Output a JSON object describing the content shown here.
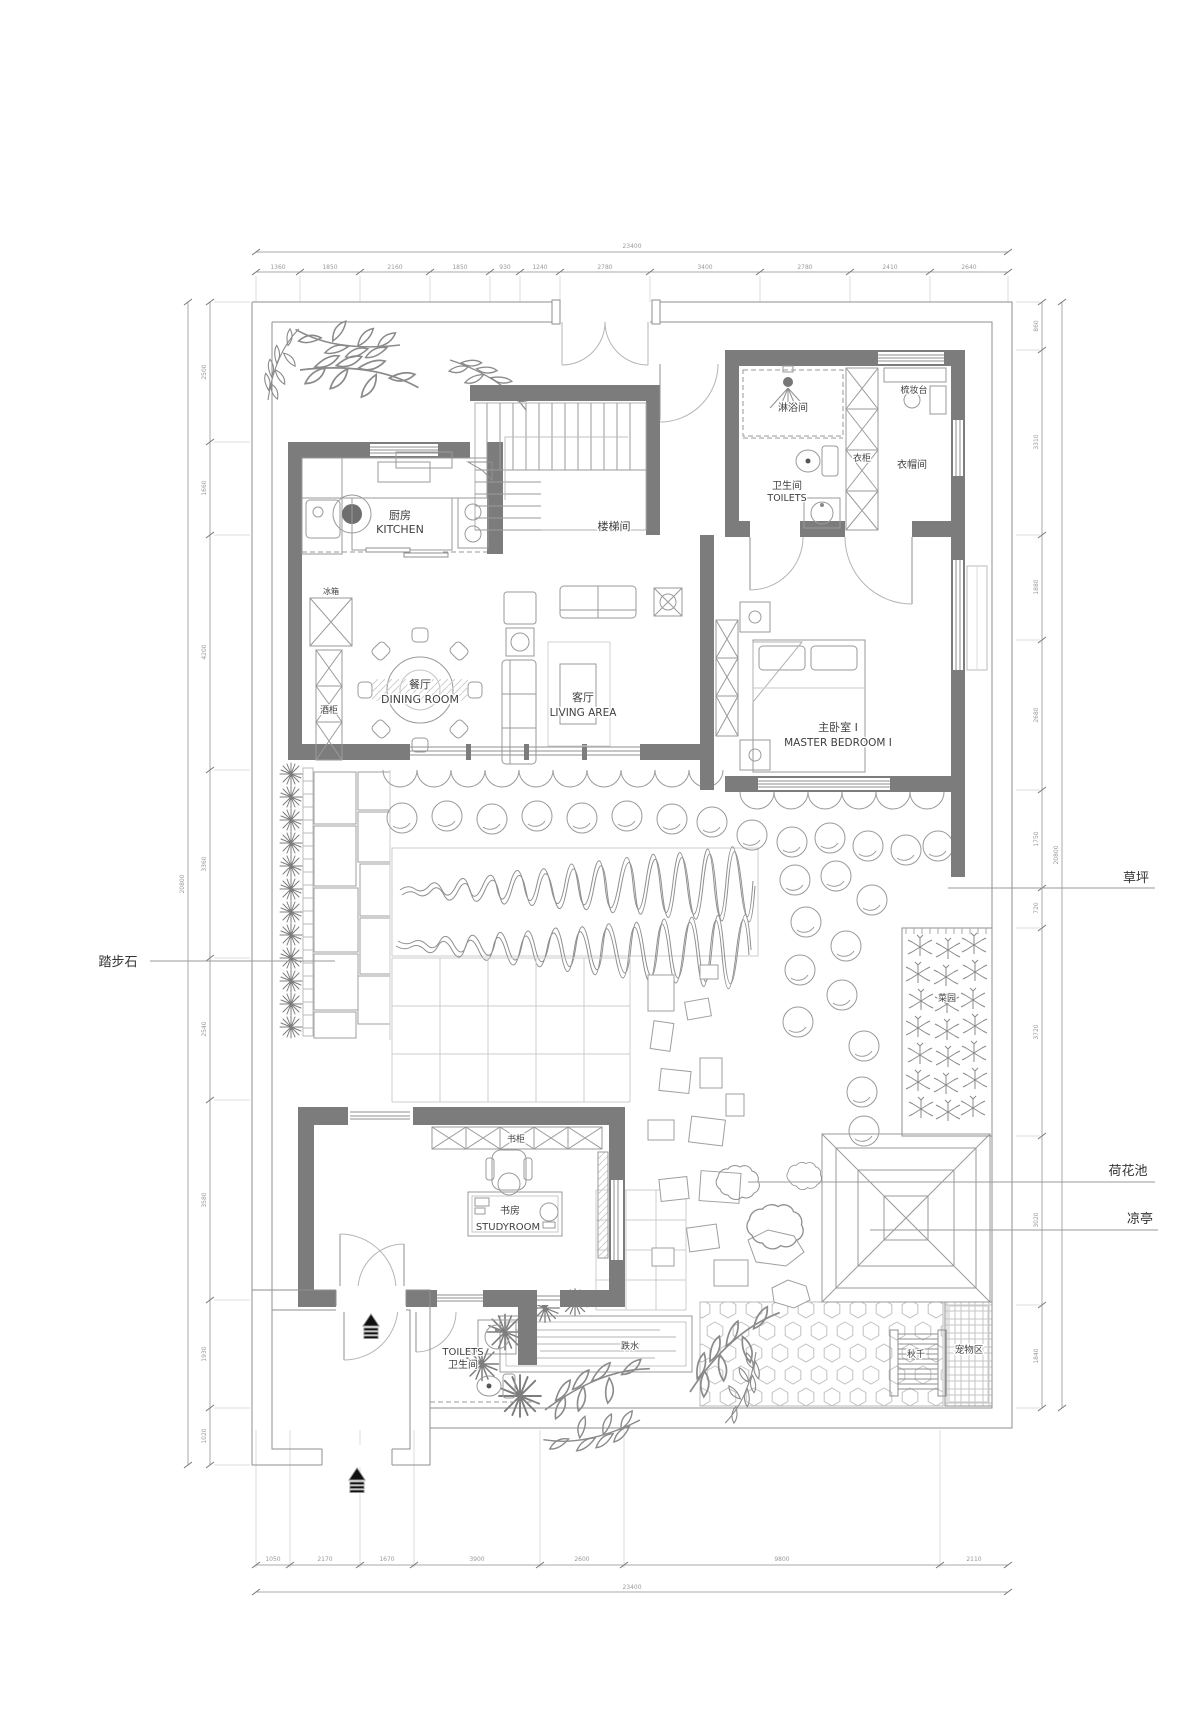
{
  "drawing": {
    "type": "residential floor plan with courtyard garden"
  },
  "rooms": {
    "kitchen": {
      "zh": "厨房",
      "en": "KITCHEN"
    },
    "stairwell": {
      "zh": "楼梯间"
    },
    "shower": {
      "zh": "淋浴间"
    },
    "toilet_upper": {
      "zh": "卫生间",
      "en": "TOILETS"
    },
    "wardrobe": {
      "zh": "衣柜"
    },
    "cloakroom": {
      "zh": "衣帽间"
    },
    "dressing_table": {
      "zh": "梳妆台"
    },
    "fridge": {
      "zh": "冰箱"
    },
    "wine_cabinet": {
      "zh": "酒柜"
    },
    "dining": {
      "zh": "餐厅",
      "en": "DINING ROOM"
    },
    "living": {
      "zh": "客厅",
      "en": "LIVING AREA"
    },
    "master_bedroom": {
      "zh": "主卧室 I",
      "en": "MASTER BEDROOM I"
    },
    "bookcase": {
      "zh": "书柜"
    },
    "study": {
      "zh": "书房",
      "en": "STUDYROOM"
    },
    "toilet_lower": {
      "en": "TOILETS",
      "zh": "卫生间"
    },
    "cascade": {
      "zh": "跌水"
    },
    "veg_garden": {
      "zh": "菜园"
    },
    "swing": {
      "zh": "秋千"
    },
    "pet_area": {
      "zh": "宠物区"
    }
  },
  "annotations": {
    "stepping_stone": "踏步石",
    "lawn": "草坪",
    "lotus_pond": "荷花池",
    "pavilion": "凉亭"
  },
  "dimensions": {
    "top_total": "23400",
    "top_segments": [
      "1360",
      "1850",
      "2160",
      "1850",
      "930",
      "1240",
      "2780",
      "3400",
      "2780",
      "2410",
      "2640"
    ],
    "left_total": "20800",
    "left_segments": [
      "2500",
      "1660",
      "4200",
      "3360",
      "2540",
      "3580",
      "1930",
      "1020"
    ],
    "right_total": "20800",
    "right_segments": [
      "860",
      "3310",
      "1880",
      "2680",
      "1750",
      "720",
      "3720",
      "3020",
      "1840"
    ],
    "bottom_total": "23400",
    "bottom_segments": [
      "1050",
      "2170",
      "1670",
      "3900",
      "2600",
      "9800",
      "2110"
    ]
  },
  "colors": {
    "wall": "#7c7c7c",
    "outline": "#9a9a9a",
    "light_line": "#c8c8c8",
    "label_text": "#3f3f3f",
    "dim_text": "#9a9a9a",
    "entry_arrow": "#111111"
  }
}
